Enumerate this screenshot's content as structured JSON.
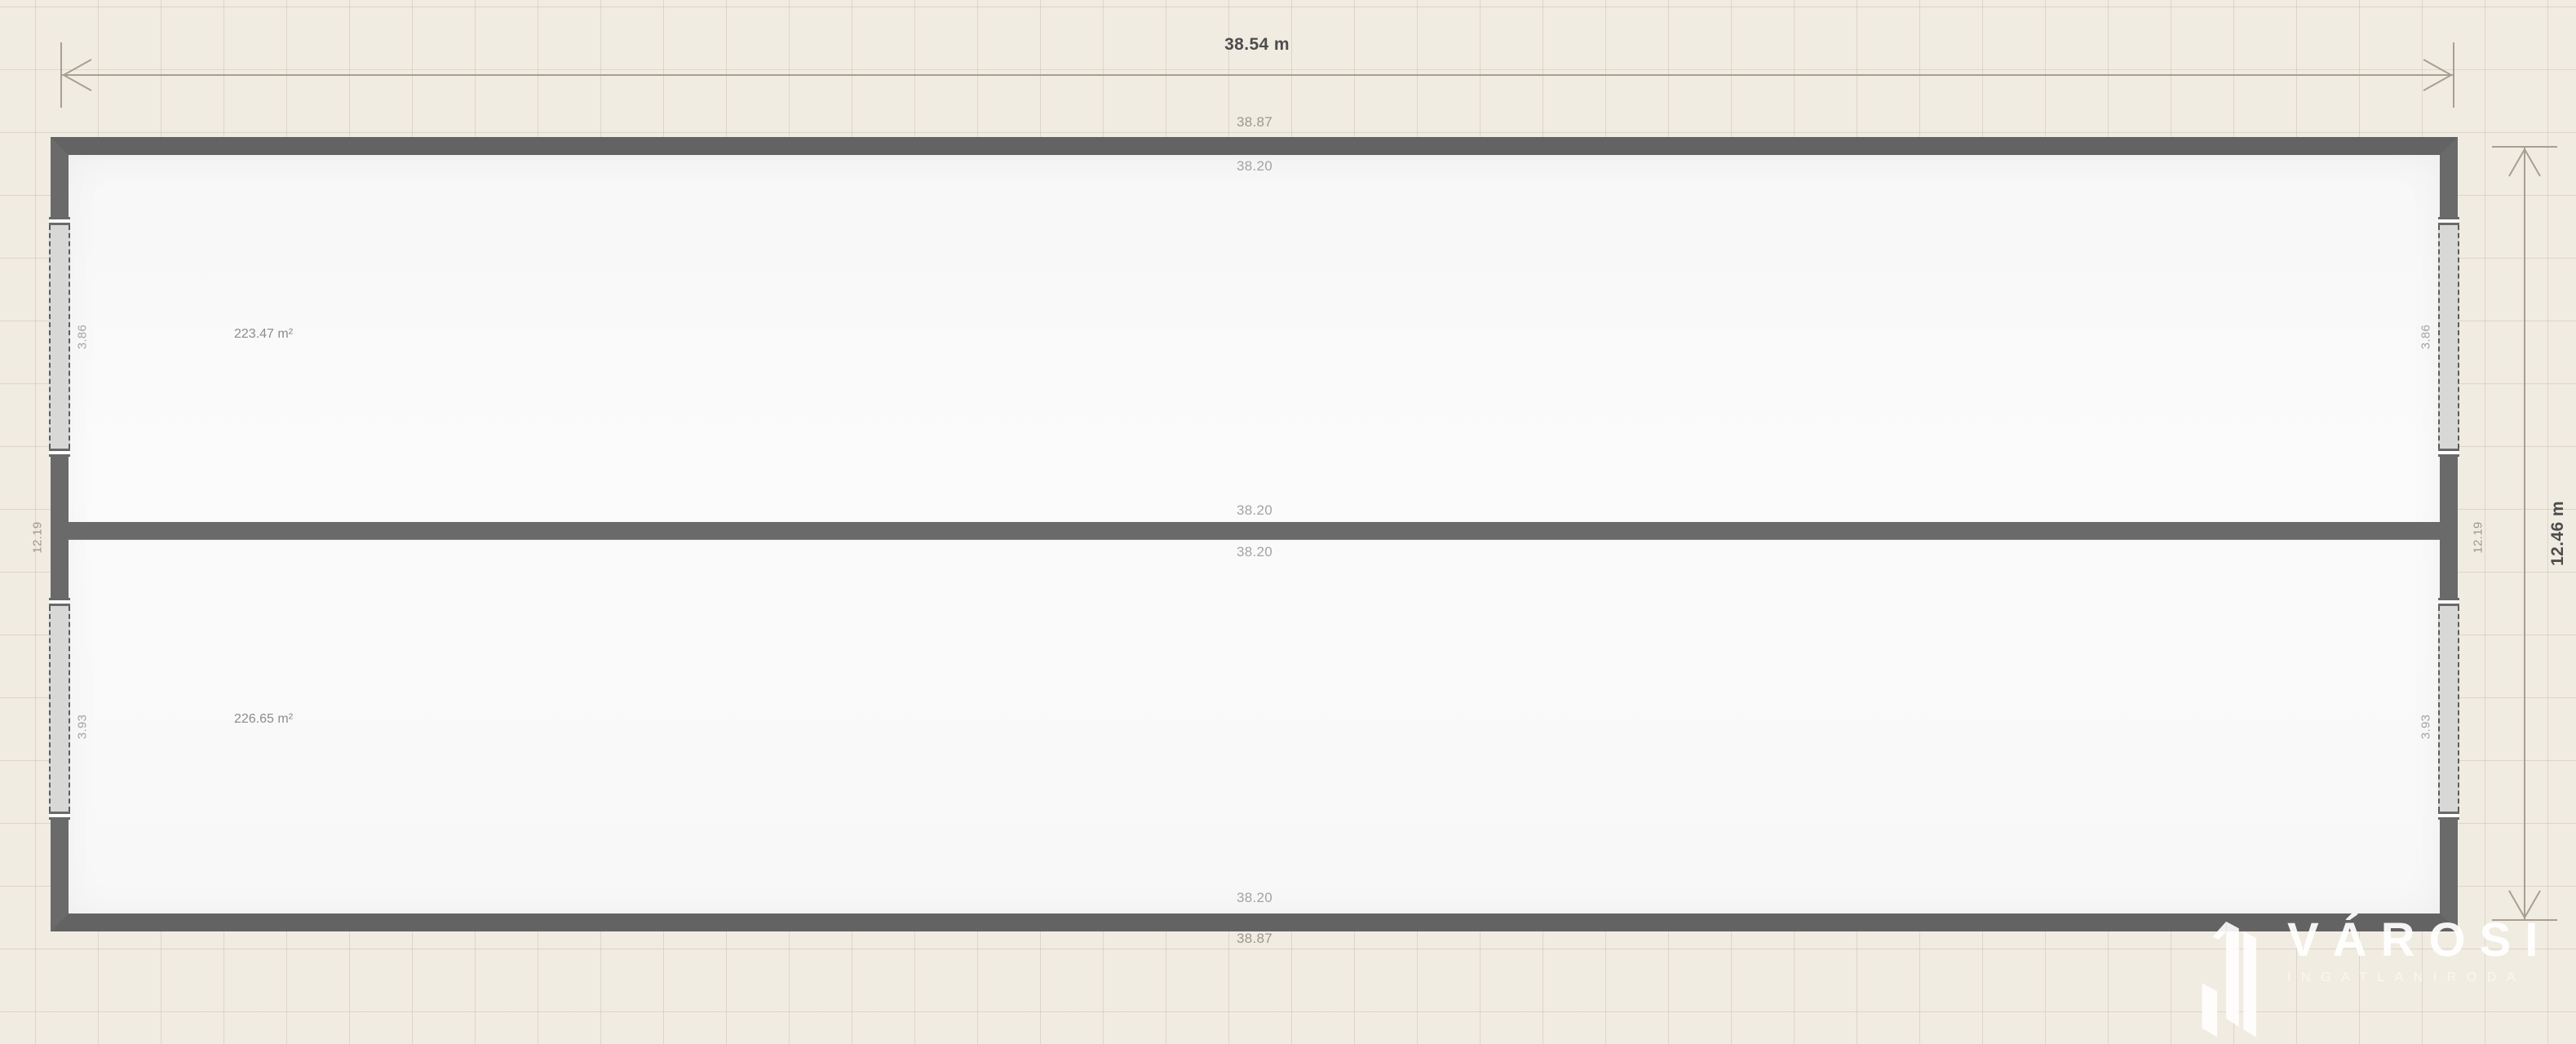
{
  "plan": {
    "overall_dimensions": {
      "width": {
        "label": "38.54 m"
      },
      "height": {
        "label": "12.46 m"
      }
    },
    "walls": {
      "top_outer": "38.87",
      "top_inner": "38.20",
      "middle_upper": "38.20",
      "middle_lower": "38.20",
      "bottom_inner": "38.20",
      "bottom_outer": "38.87",
      "left_length": "12.19",
      "right_length": "12.19"
    },
    "rooms": [
      {
        "name": "upper-hall",
        "area": "223.47 m²"
      },
      {
        "name": "lower-hall",
        "area": "226.65 m²"
      }
    ],
    "windows": [
      {
        "side": "left",
        "row": "top",
        "label": "3.86"
      },
      {
        "side": "left",
        "row": "bottom",
        "label": "3.93"
      },
      {
        "side": "right",
        "row": "top",
        "label": "3.86"
      },
      {
        "side": "right",
        "row": "bottom",
        "label": "3.93"
      }
    ],
    "colors": {
      "background": "#f1ece2",
      "grid_line": "#e4ddcf",
      "wall": "#6a6a6a",
      "floor": "#fafafa",
      "window_fill": "#d8d8d6",
      "dimension_line": "#a89f90",
      "dimension_text": "#4d4d4d",
      "label_text": "#9c988f"
    }
  },
  "branding": {
    "name": "VÁROSI",
    "tagline": "INGATLANIRODA",
    "logo_icon": "building-icon",
    "color": "#ffffff"
  }
}
